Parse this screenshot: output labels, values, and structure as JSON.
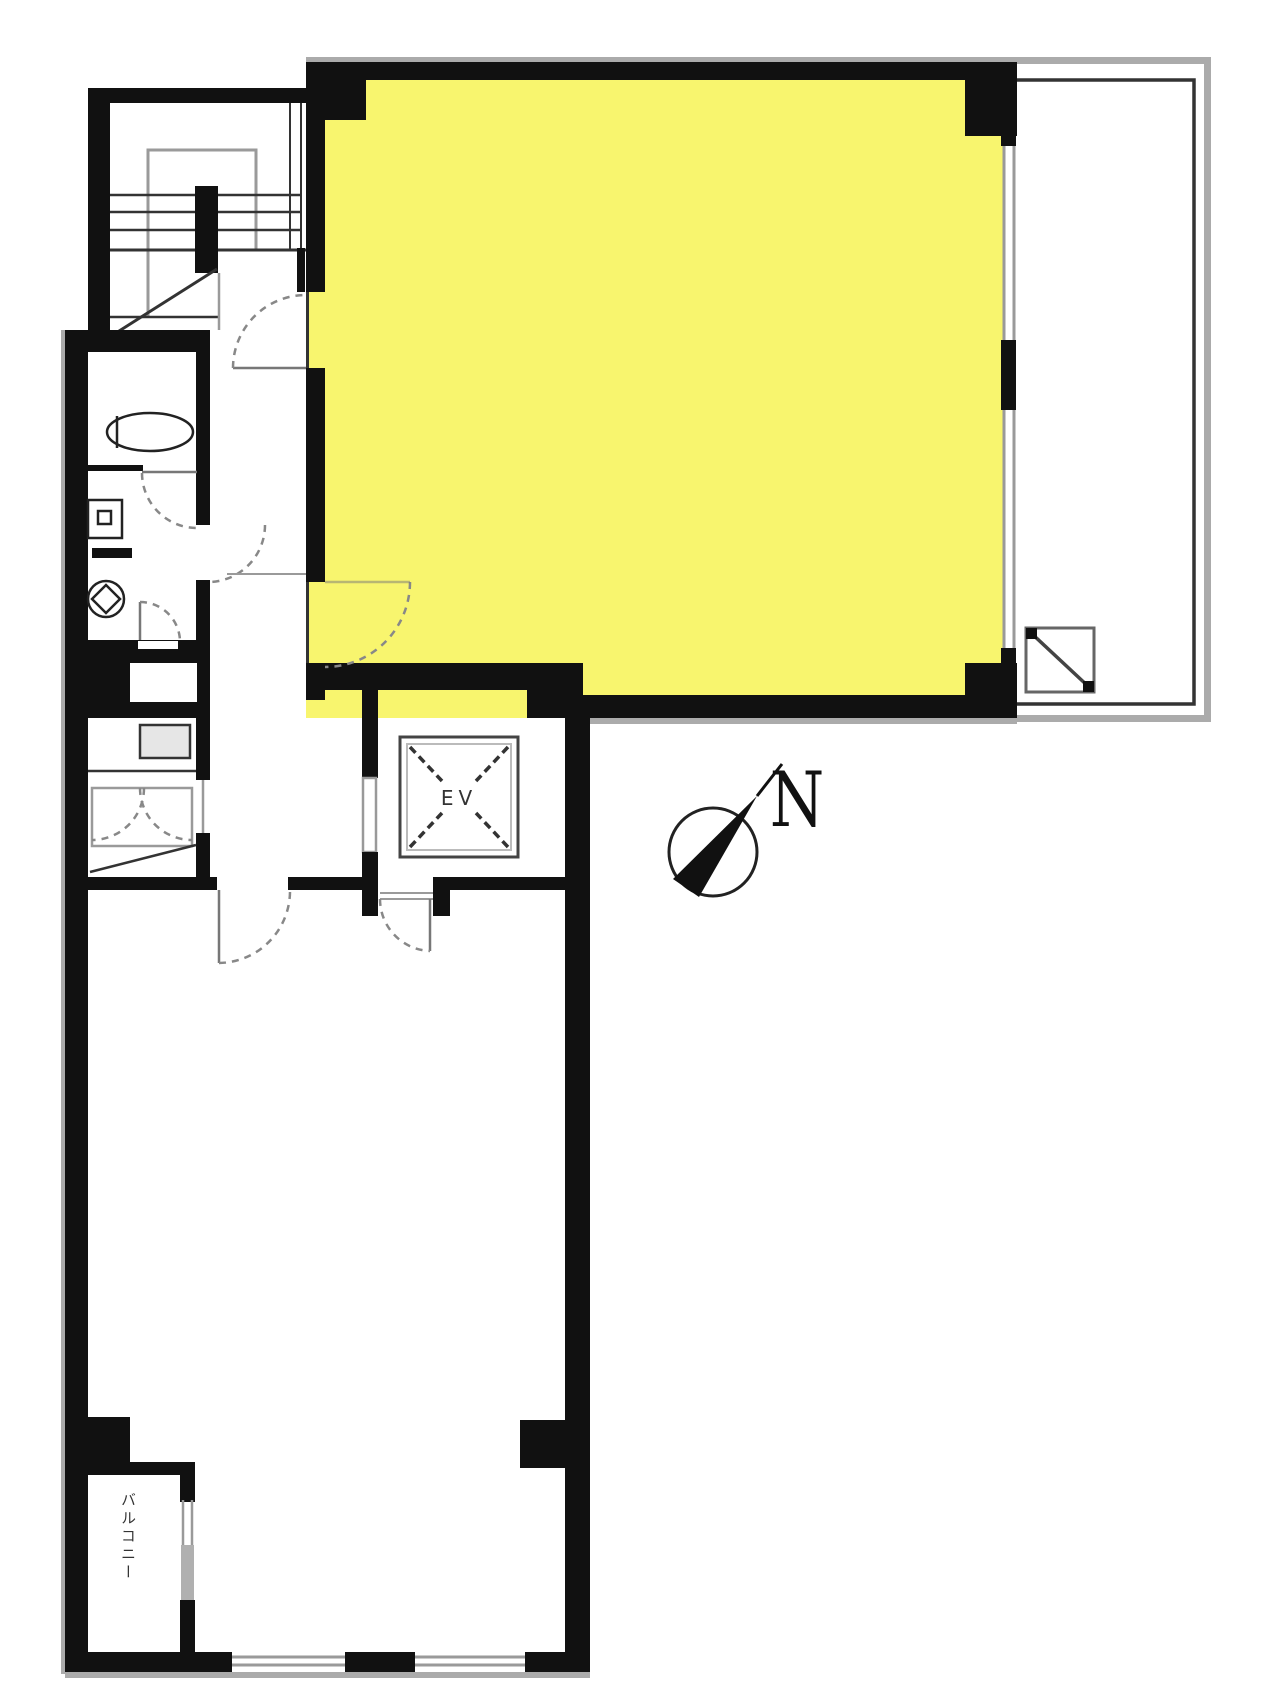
{
  "labels": {
    "elevator": "EV",
    "compass_north": "N",
    "balcony": "バルコニー"
  },
  "colors": {
    "room_highlight": "#F8F56E",
    "wall": "#111111",
    "dark_line": "#333333",
    "gray_line": "#9a9a9a",
    "outer_cap": "#ababab",
    "door_arc": "#888888",
    "door_leaf": "#777777",
    "fixture_line": "#222222",
    "background": "#ffffff"
  }
}
